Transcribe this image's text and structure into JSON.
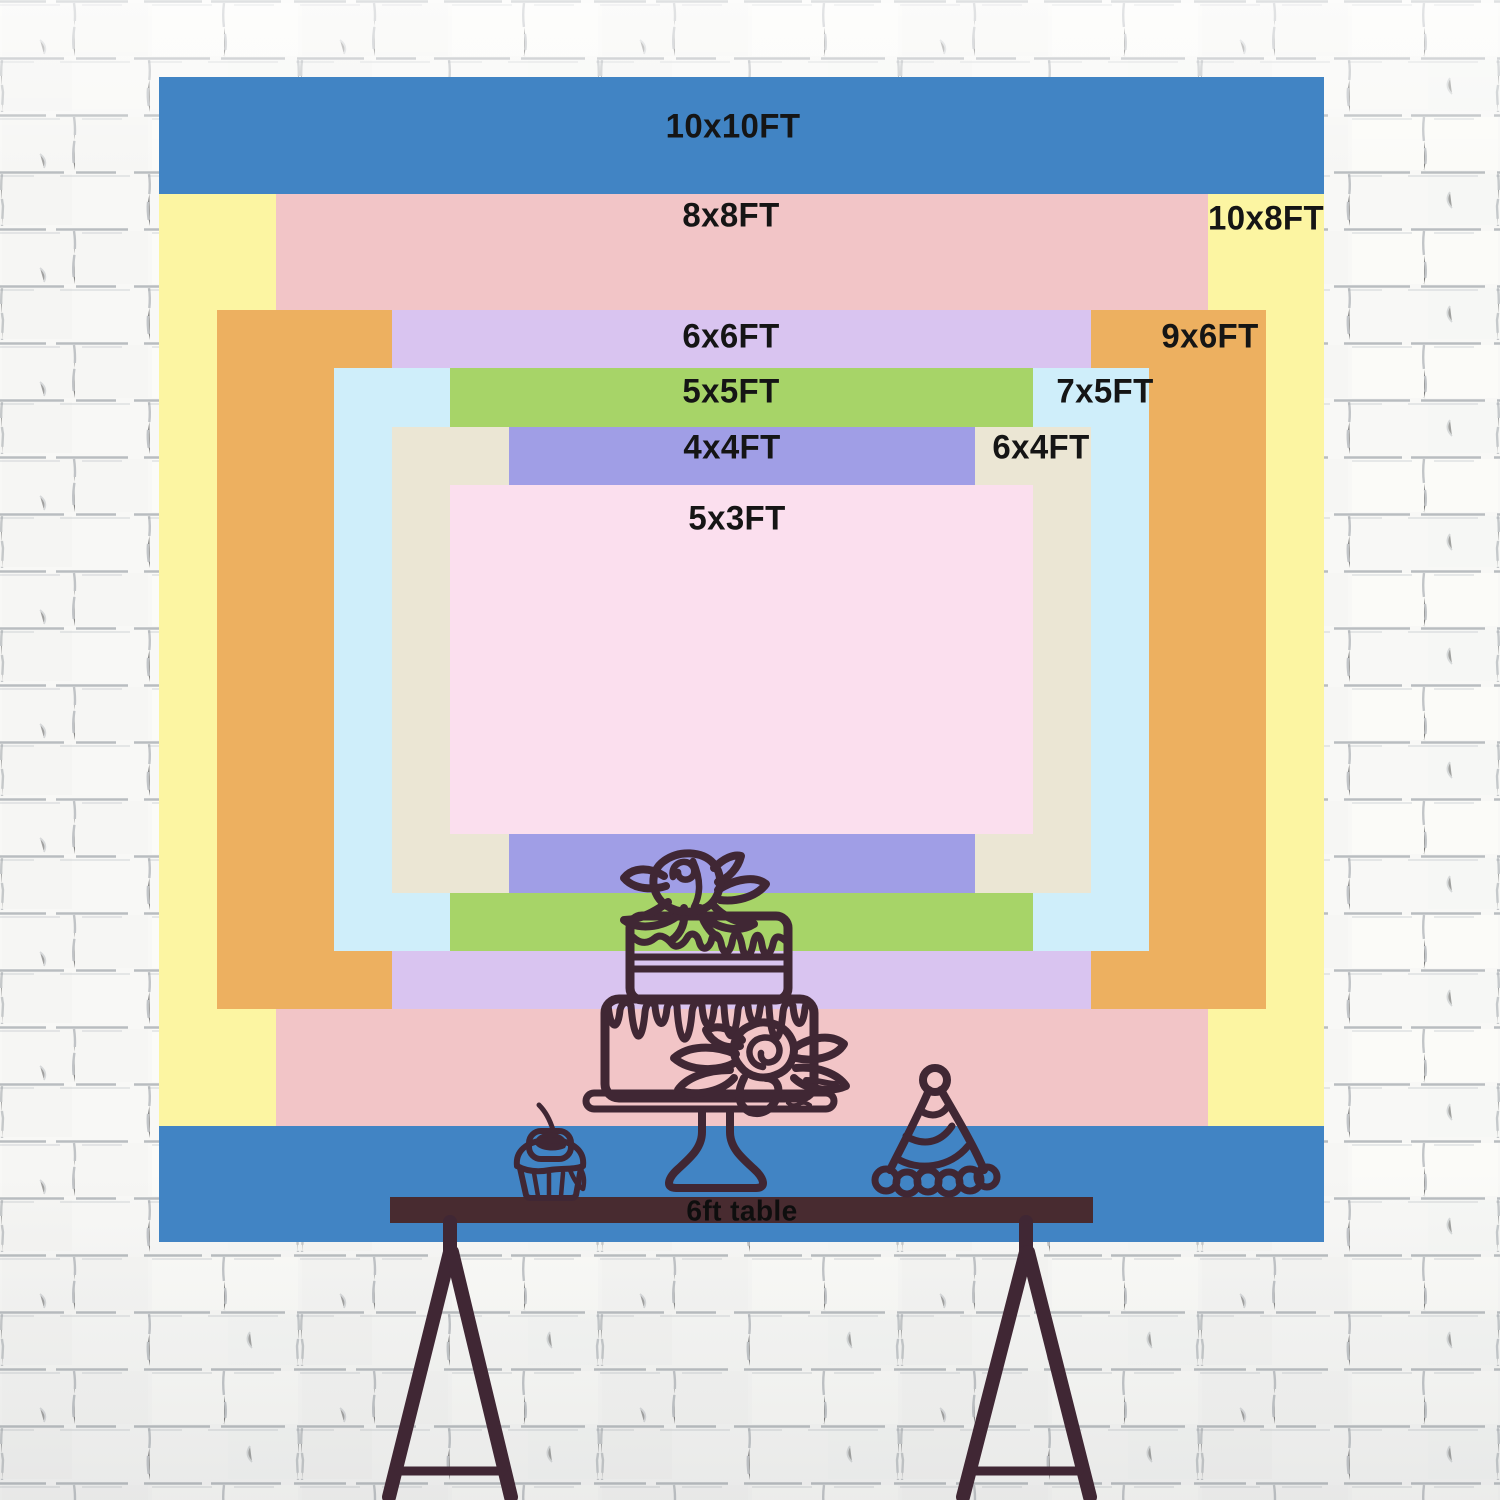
{
  "backdrop_size_chart": {
    "units": "FT",
    "sizes": [
      {
        "label": "10x10FT",
        "width_ft": 10,
        "height_ft": 10,
        "color": "#4184c4",
        "label_placement": "top"
      },
      {
        "label": "10x8FT",
        "width_ft": 10,
        "height_ft": 8,
        "color": "#fcf5a2",
        "label_placement": "right"
      },
      {
        "label": "8x8FT",
        "width_ft": 8,
        "height_ft": 8,
        "color": "#f2c5c7",
        "label_placement": "top"
      },
      {
        "label": "9x6FT",
        "width_ft": 9,
        "height_ft": 6,
        "color": "#edb060",
        "label_placement": "right"
      },
      {
        "label": "6x6FT",
        "width_ft": 6,
        "height_ft": 6,
        "color": "#d9c4f0",
        "label_placement": "top"
      },
      {
        "label": "7x5FT",
        "width_ft": 7,
        "height_ft": 5,
        "color": "#cfeefa",
        "label_placement": "right"
      },
      {
        "label": "5x5FT",
        "width_ft": 5,
        "height_ft": 5,
        "color": "#a7d468",
        "label_placement": "top"
      },
      {
        "label": "6x4FT",
        "width_ft": 6,
        "height_ft": 4,
        "color": "#ebe6d4",
        "label_placement": "right"
      },
      {
        "label": "4x4FT",
        "width_ft": 4,
        "height_ft": 4,
        "color": "#a09ee6",
        "label_placement": "top"
      },
      {
        "label": "5x3FT",
        "width_ft": 5,
        "height_ft": 3,
        "color": "#fbdfee",
        "label_placement": "top"
      }
    ],
    "label_text_color": "#151515"
  },
  "table": {
    "label": "6ft table",
    "length_ft": 6
  },
  "illustrations": [
    "tiered-cake-on-stand-icon",
    "cupcake-with-cherry-icon",
    "party-hat-icon",
    "trestle-table-icon"
  ],
  "ink_color": "#402734",
  "table_bar_color": "#482b30"
}
